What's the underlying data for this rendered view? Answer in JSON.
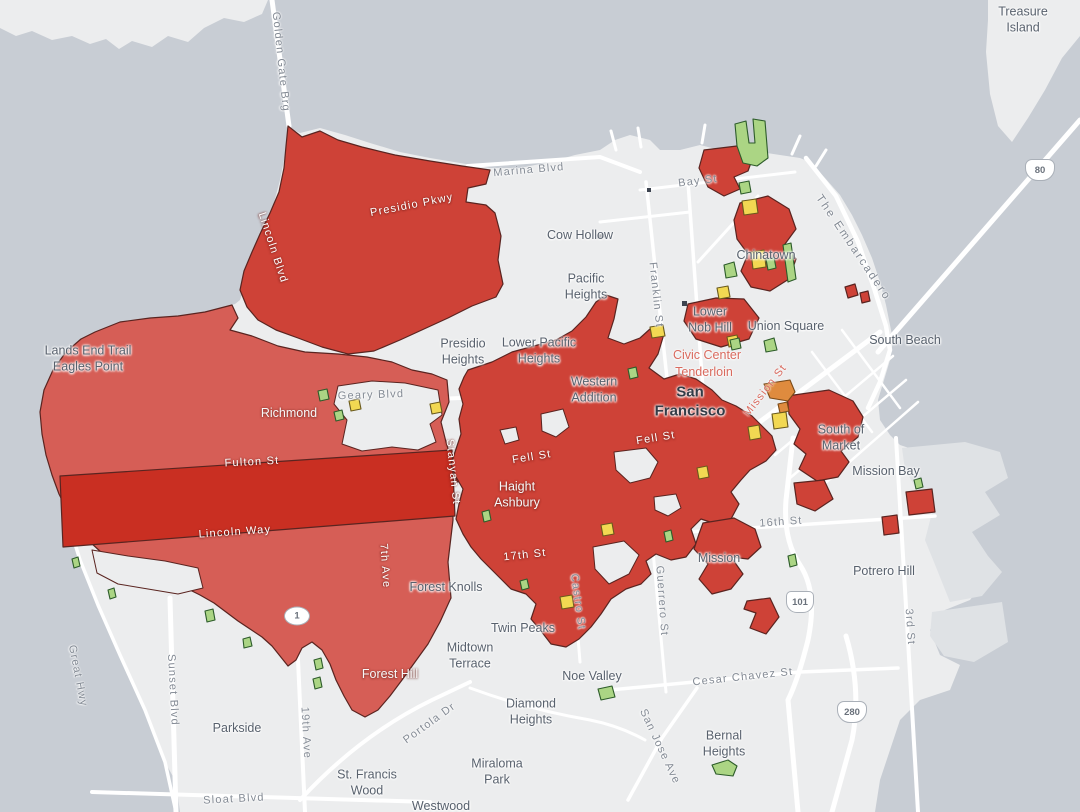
{
  "colors": {
    "water": "#c8cdd4",
    "land": "#ecedee",
    "land_shade": "#dfe2e5",
    "road": "#ffffff",
    "red_main": "#ce4237",
    "red_light": "#d65e56",
    "red_dark": "#c92f22",
    "yellow": "#f2d852",
    "green": "#abd584",
    "orange": "#df8b3e",
    "outline": "#5a2420",
    "green_outline": "#2d5c2a",
    "yellow_outline": "#6a5a1c",
    "orange_outline": "#7a4a18",
    "label_gray": "#58616d",
    "label_dark": "#333c47",
    "label_street": "#838a94",
    "label_red": "#d96a5e"
  },
  "labels": {
    "golden_gate_brg": "Golden Gate Brg",
    "treasure_island": "Treasure\nIsland",
    "marina_blvd": "Marina Blvd",
    "bay_st": "Bay St",
    "cow_hollow": "Cow Hollow",
    "pacific_heights": "Pacific\nHeights",
    "franklin_st": "Franklin St",
    "chinatown": "Chinatown",
    "the_embarcadero": "The Embarcadero",
    "lower_nob_hill": "Lower\nNob Hill",
    "union_square": "Union Square",
    "south_beach": "South Beach",
    "civic_center": "Civic Center",
    "tenderloin": "Tenderloin",
    "san_francisco": "San\nFrancisco",
    "mission_st": "Mission St",
    "presidio_heights": "Presidio\nHeights",
    "lower_pacific_heights": "Lower Pacific\nHeights",
    "western_addition": "Western\nAddition",
    "geary_blvd": "Geary Blvd",
    "richmond": "Richmond",
    "lands_end": "Lands End Trail\nEagles Point",
    "fulton_st": "Fulton St",
    "fell_st_1": "Fell St",
    "fell_st_2": "Fell St",
    "stanyan_st": "Stanyan St",
    "haight_ashbury": "Haight\nAshbury",
    "lincoln_way": "Lincoln Way",
    "seventh_ave": "7th Ave",
    "seventeenth_st": "17th St",
    "forest_knolls": "Forest Knolls",
    "castro_st": "Castro St",
    "guerrero_st": "Guerrero St",
    "mission": "Mission",
    "sixteenth_st": "16th St",
    "potrero_hill": "Potrero Hill",
    "mission_bay": "Mission Bay",
    "south_of_market": "South of\nMarket",
    "twin_peaks": "Twin Peaks",
    "midtown_terrace": "Midtown\nTerrace",
    "noe_valley": "Noe Valley",
    "forest_hill": "Forest Hill",
    "diamond_heights": "Diamond\nHeights",
    "parkside": "Parkside",
    "sunset_blvd": "Sunset Blvd",
    "great_hwy": "Great Hwy",
    "nineteenth_ave": "19th Ave",
    "st_francis_wood": "St. Francis\nWood",
    "westwood": "Westwood",
    "miraloma_park": "Miraloma\nPark",
    "portola_dr": "Portola Dr",
    "cesar_chavez_st": "Cesar Chavez St",
    "bernal_heights": "Bernal\nHeights",
    "san_jose_ave": "San Jose Ave",
    "sloat_blvd": "Sloat Blvd",
    "third_st": "3rd St",
    "lincoln_blvd": "Lincoln Blvd",
    "presidio_pkwy": "Presidio Pkwy"
  },
  "shields": {
    "hwy_1": "1",
    "us_101": "101",
    "i_280": "280",
    "i_80": "80"
  }
}
